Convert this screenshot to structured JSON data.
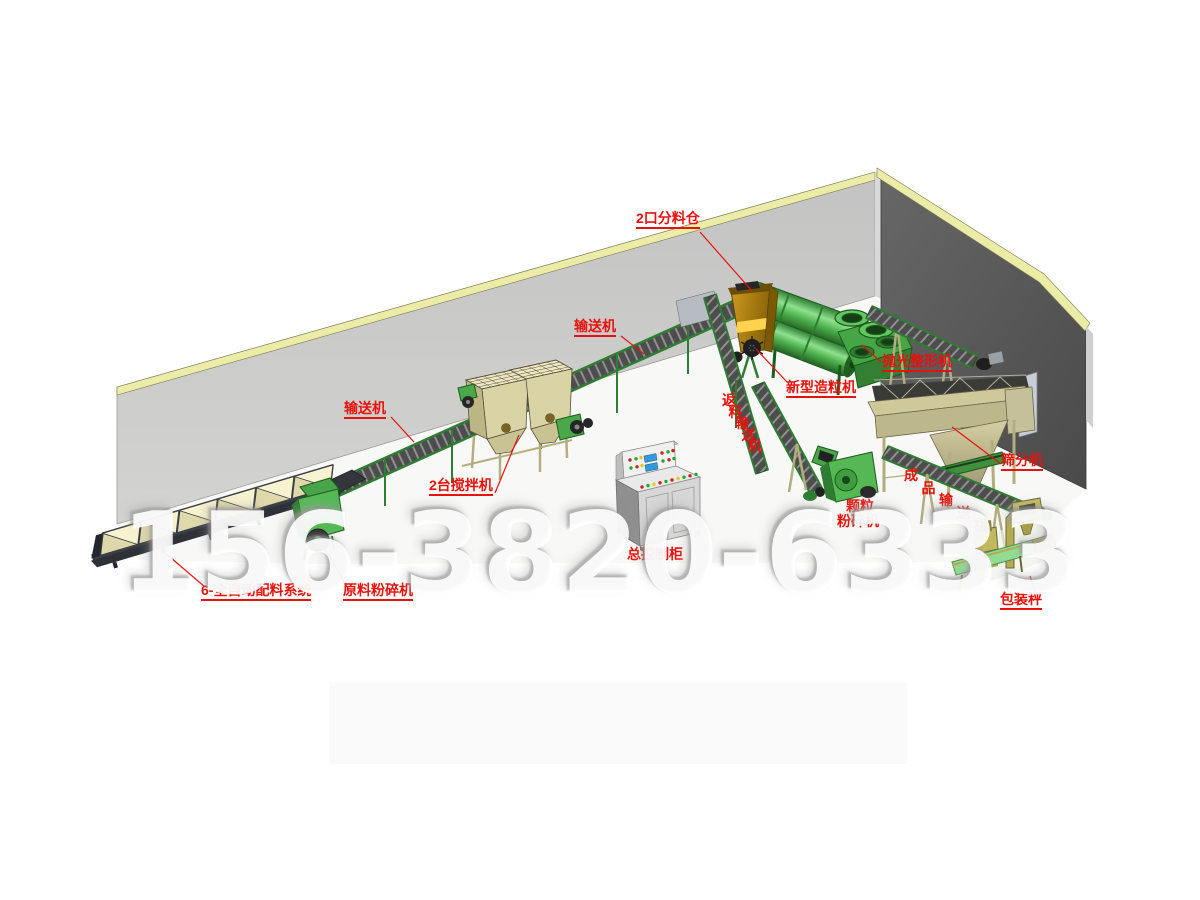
{
  "watermark_phone": "156-3820-6333",
  "labels": {
    "distribution_bin": "2口分料仓",
    "conveyor_upper": "输送机",
    "conveyor_lower": "输送机",
    "mixers": "2台搅拌机",
    "return_conveyor": "返料输送机",
    "granulator": "新型造粒机",
    "polisher": "抛光整形机",
    "screener": "筛分机",
    "product_conveyor": "成品输送机",
    "granule_crusher_line1": "颗粒",
    "granule_crusher_line2": "粉碎机",
    "control_cabinet": "总控制柜",
    "batching_system": "6-全自动配料系统",
    "raw_material_crusher": "原料粉碎机",
    "packing_scale": "包装秤"
  },
  "colors": {
    "label_red": "#e8120c",
    "machine_green": "#4aa84a",
    "machine_green_dark": "#1d5c1d",
    "frame_khaki": "#b3ae7e",
    "hopper_cream": "#f0eabc",
    "bin_gold": "#b8860b",
    "wall_light": "#cacaca",
    "wall_dark": "#555555",
    "wall_trim_yellow": "#ececa9",
    "belt_dark": "#4d4d4d"
  }
}
